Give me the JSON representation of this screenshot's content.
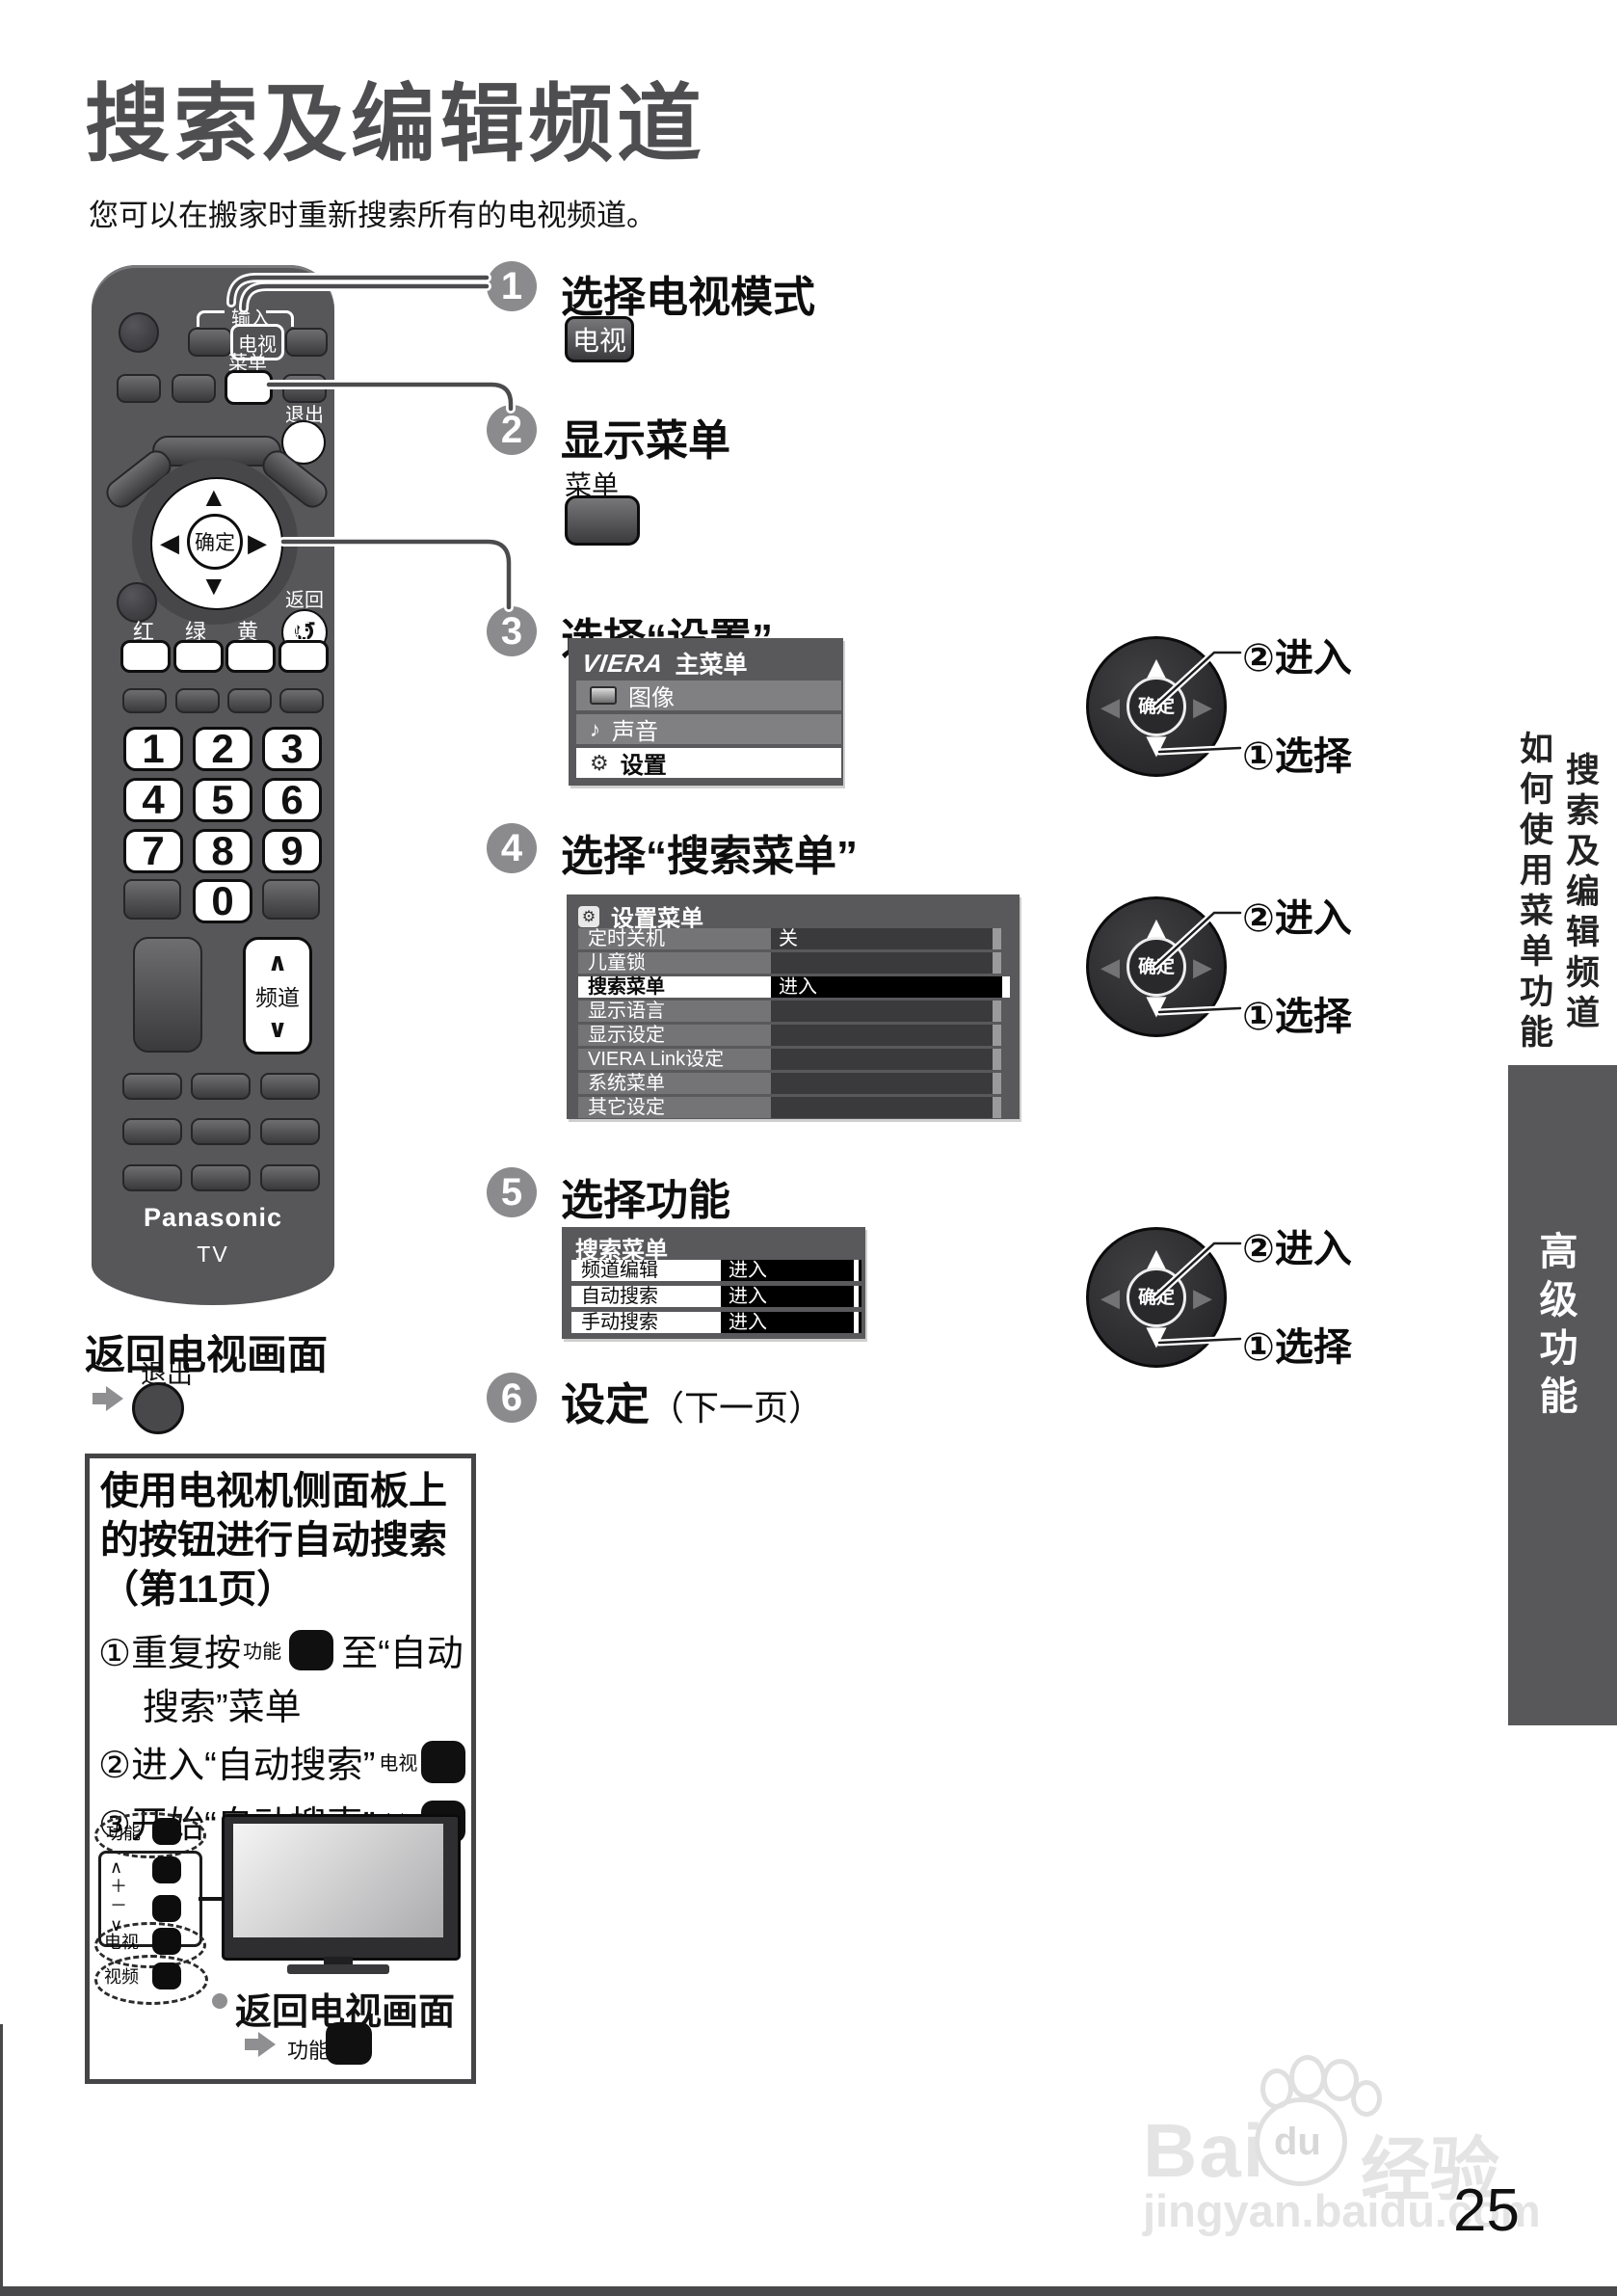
{
  "page": {
    "title": "搜索及编辑频道",
    "subtitle": "您可以在搬家时重新搜索所有的电视频道。",
    "page_number": "25"
  },
  "steps": {
    "s1": {
      "num": "1",
      "title": "选择电视模式",
      "key": "电视"
    },
    "s2": {
      "num": "2",
      "title": "显示菜单",
      "key_label": "菜单"
    },
    "s3": {
      "num": "3",
      "title": "选择“设置”"
    },
    "s4": {
      "num": "4",
      "title": "选择“搜索菜单”"
    },
    "s5": {
      "num": "5",
      "title": "选择功能"
    },
    "s6": {
      "num": "6",
      "title": "设定",
      "suffix": "（下一页）"
    }
  },
  "viera_menu": {
    "logo": "VIERA",
    "title": "主菜单",
    "items": [
      {
        "label": "图像"
      },
      {
        "label": "声音"
      },
      {
        "label": "设置"
      }
    ]
  },
  "setup_menu": {
    "title": "设置菜单",
    "rows": [
      {
        "label": "定时关机",
        "value": "关"
      },
      {
        "label": "儿童锁",
        "value": ""
      },
      {
        "label": "搜索菜单",
        "value": "进入"
      },
      {
        "label": "显示语言",
        "value": ""
      },
      {
        "label": "显示设定",
        "value": ""
      },
      {
        "label": "VIERA Link设定",
        "value": ""
      },
      {
        "label": "系统菜单",
        "value": ""
      },
      {
        "label": "其它设定",
        "value": ""
      }
    ]
  },
  "search_menu": {
    "title": "搜索菜单",
    "rows": [
      {
        "label": "频道编辑",
        "value": "进入"
      },
      {
        "label": "自动搜索",
        "value": "进入"
      },
      {
        "label": "手动搜索",
        "value": "进入"
      }
    ]
  },
  "dpad": {
    "ok": "确定",
    "enter": "②进入",
    "select": "①选择"
  },
  "remote": {
    "brand": "Panasonic",
    "model": "TV",
    "input_label": "输入",
    "tv_key": "电视",
    "menu_label": "菜单",
    "exit_label": "退出",
    "ok": "确定",
    "back_label": "返回",
    "back_icon": "↺",
    "color_keys": [
      "红",
      "绿",
      "黄",
      "蓝"
    ],
    "digits": [
      "1",
      "2",
      "3",
      "4",
      "5",
      "6",
      "7",
      "8",
      "9",
      "0"
    ],
    "channel_label": "频道",
    "up": "∧",
    "down": "∨"
  },
  "return_tv": {
    "heading": "返回电视画面",
    "exit_label": "退出"
  },
  "side_box": {
    "title_line1": "使用电视机侧面板上",
    "title_line2": "的按钮进行自动搜索",
    "title_line3": "（第11页）",
    "step1_pre": "①重复按",
    "step1_key": "功能",
    "step1_post": "至“自动",
    "step1_line2": "搜索”菜单",
    "step2_text": "②进入“自动搜索”",
    "step2_key": "电视",
    "step3_text": "③开始“自动搜索”",
    "step3_key": "电视",
    "panel": {
      "fn": "功能",
      "up": "∧",
      "plus": "＋",
      "minus": "－",
      "down": "∨",
      "tv": "电视",
      "av": "视频"
    },
    "footer_text": "返回电视画面",
    "footer_key": "功能"
  },
  "sidebar": {
    "col1": "如何使用菜单功能",
    "col2": "搜索及编辑频道",
    "tab": "高级功能"
  },
  "watermark": {
    "p1": "Bai",
    "p2": "du",
    "p3": "经验",
    "url": "jingyan.baidu.com"
  }
}
